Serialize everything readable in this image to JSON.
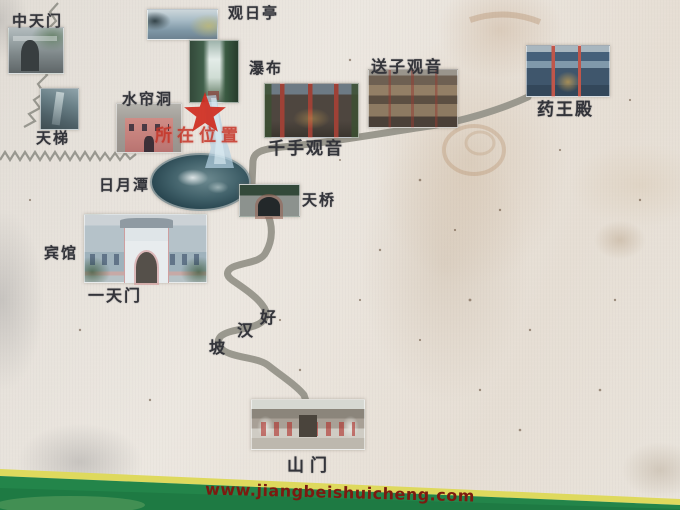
{
  "map": {
    "current_location_label": "所在位置",
    "website": "www.jiangbeishuicheng.com",
    "locations": [
      {
        "id": "zhongtianmen",
        "label": "中天门"
      },
      {
        "id": "tianti",
        "label": "天梯"
      },
      {
        "id": "guanriting",
        "label": "观日亭"
      },
      {
        "id": "pubu",
        "label": "瀑布"
      },
      {
        "id": "shuiliandong",
        "label": "水帘洞"
      },
      {
        "id": "qianshouguanyin",
        "label": "千手观音"
      },
      {
        "id": "songziguanyin",
        "label": "送子观音"
      },
      {
        "id": "yaowangdian",
        "label": "药王殿"
      },
      {
        "id": "riyuetan",
        "label": "日月潭"
      },
      {
        "id": "tianqiao",
        "label": "天桥"
      },
      {
        "id": "binguan",
        "label": "宾馆"
      },
      {
        "id": "yitianmen",
        "label": "一天门"
      },
      {
        "id": "shanmen",
        "label": "山门"
      }
    ],
    "slope_name_chars": [
      "好",
      "汉",
      "坡"
    ],
    "colors": {
      "road": "#9a988e",
      "star_red": "#cf2d20",
      "label_text": "#33343a",
      "website_text": "#7c1a10",
      "band_green": "#23854a",
      "band_yellow": "#ded95d"
    }
  }
}
